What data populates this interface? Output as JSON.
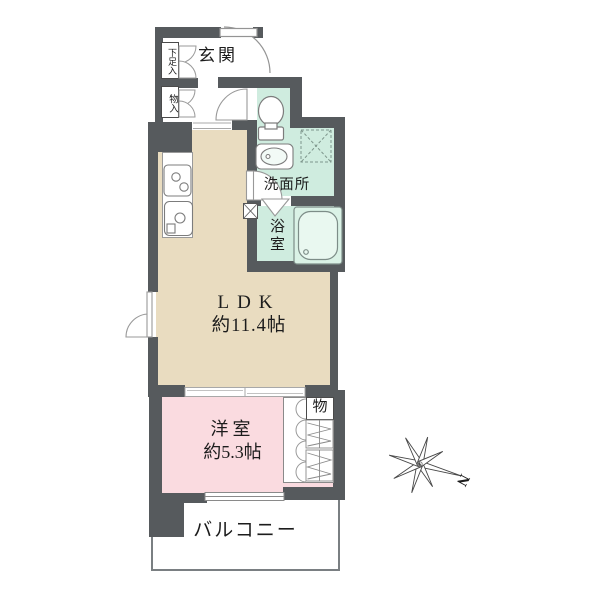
{
  "type": "floorplan",
  "rooms": {
    "genkan": {
      "label": "玄関"
    },
    "shoe_cabinet": {
      "label": "下足入"
    },
    "hall_storage": {
      "label": "物入"
    },
    "washroom": {
      "label": "洗面所"
    },
    "bathroom": {
      "label": "浴室"
    },
    "ldk": {
      "label": "LDK",
      "area": "約11.4帖"
    },
    "bedroom": {
      "label": "洋室",
      "area": "約5.3帖"
    },
    "bedroom_closet": {
      "label": "物"
    },
    "balcony": {
      "label": "バルコニー"
    }
  },
  "compass": {
    "north_label": "N"
  },
  "fixtures": [
    "toilet-icon",
    "washbasin-icon",
    "bathtub-icon",
    "washer-pan-icon",
    "stove-icon",
    "kitchen-sink-icon",
    "hanger-pipe-icon",
    "compass-icon"
  ],
  "colors": {
    "wall": "#565a5d",
    "ldk_floor": "#e9dcc0",
    "bedroom_floor": "#fadbe0",
    "wet_area_floor": "#cfecdf",
    "balcony_floor": "#ffffff",
    "background": "#ffffff",
    "fixture_line": "#8a8a8a",
    "text": "#1c1c1c"
  }
}
